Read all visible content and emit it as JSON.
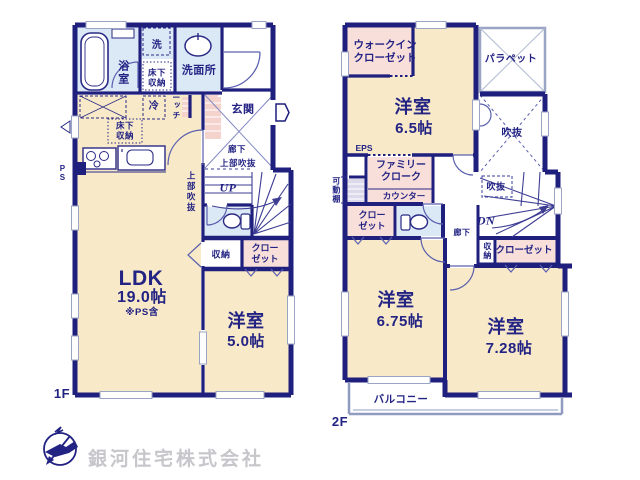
{
  "company": "銀河住宅株式会社",
  "floor1": {
    "tag": "1F",
    "bath": "浴室",
    "laundry": "洗",
    "underfloor_storage_top": "床下収納",
    "washroom": "洗面所",
    "fridge": "冷",
    "niche": "ニッチ",
    "underfloor_storage_kitchen": "床下収納",
    "entrance": "玄関",
    "hallway": "廊下",
    "upper_void_hallway": "上部吹抜",
    "upper_void_ldk": "上部吹抜",
    "stairs_label": "UP",
    "pipe_space": "PS",
    "storage": "収納",
    "closet": "クローゼット",
    "ldk_name": "LDK",
    "ldk_size": "19.0帖",
    "ldk_note": "※PS含",
    "bedroom_name": "洋室",
    "bedroom_size": "5.0帖"
  },
  "floor2": {
    "tag": "2F",
    "walk_in_closet": "ウォークインクローゼット",
    "bedroom_a_name": "洋室",
    "bedroom_a_size": "6.5帖",
    "parapet": "パラペット",
    "void_main": "吹抜",
    "void_stair": "吹抜",
    "eps": "EPS",
    "movable_shelf": "可動棚",
    "family_cloak": "ファミリークローク",
    "counter": "カウンター",
    "closet_small": "クローゼット",
    "hallway": "廊下",
    "stairs_label": "DN",
    "storage": "収納",
    "closet_wide": "クローゼット",
    "bedroom_b_name": "洋室",
    "bedroom_b_size": "6.75帖",
    "bedroom_c_name": "洋室",
    "bedroom_c_size": "7.28帖",
    "balcony": "バルコニー"
  },
  "colors": {
    "wall": "#1f1f7d",
    "room_floor": "#f8e9c8",
    "closet": "#f9dfda",
    "wet_area": "#dbe9f6",
    "accent_hatch": "#f5d3cd",
    "thin_line": "#9aa4c4",
    "text": "#232384",
    "logo_text": "#c6c6cb"
  }
}
